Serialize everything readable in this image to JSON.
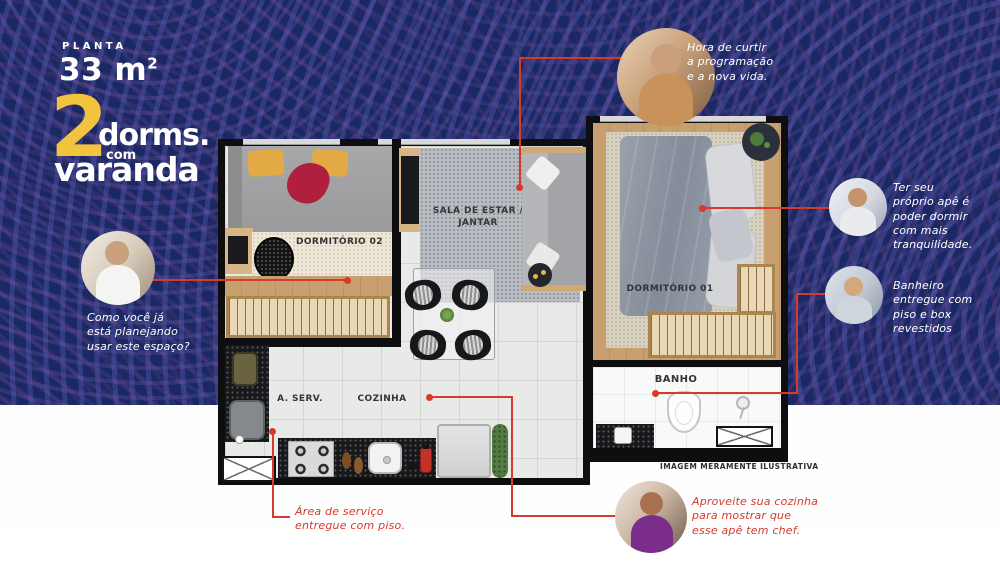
{
  "header": {
    "planta_label": "PLANTA",
    "area_value": "33 m",
    "area_exponent": "2",
    "logo": {
      "number": "2",
      "word1": "dorms.",
      "word2": "com",
      "word3": "varanda"
    }
  },
  "plan": {
    "labels": {
      "dorm2": "DORMITÓRIO 02",
      "sala_line1": "SALA DE ESTAR /",
      "sala_line2": "JANTAR",
      "dorm1": "DORMITÓRIO 01",
      "aserv": "A. SERV.",
      "cozinha": "COZINHA",
      "banho": "BANHO"
    },
    "disclaimer": "IMAGEM MERAMENTE ILUSTRATIVA"
  },
  "callouts": {
    "tv": {
      "photo": "woman-using-phone",
      "lines": [
        "Hora de curtir",
        "a programação",
        "e a nova vida."
      ]
    },
    "planning": {
      "photo": "woman-on-call-at-laptop",
      "lines": [
        "Como você já",
        "está planejando",
        "usar este espaço?"
      ]
    },
    "sleep": {
      "photo": "woman-sleeping",
      "lines": [
        "Ter seu",
        "próprio apê é",
        "poder dormir",
        "com mais",
        "tranquilidade."
      ]
    },
    "bath": {
      "photo": "woman-showering",
      "lines": [
        "Banheiro",
        "entregue com",
        "piso e box",
        "revestidos"
      ]
    },
    "chef": {
      "photo": "woman-cooking",
      "lines": [
        "Aproveite sua cozinha",
        "para mostrar que",
        "esse apê tem chef."
      ]
    },
    "service": {
      "lines": [
        "Área de serviço",
        "entregue com piso."
      ]
    }
  },
  "colors": {
    "background_navy": "#1a2963",
    "ring_purple": "#6a54a8",
    "accent_red": "#d63a2c",
    "brand_yellow": "#f2c43d",
    "note_white": "#ffffff"
  }
}
